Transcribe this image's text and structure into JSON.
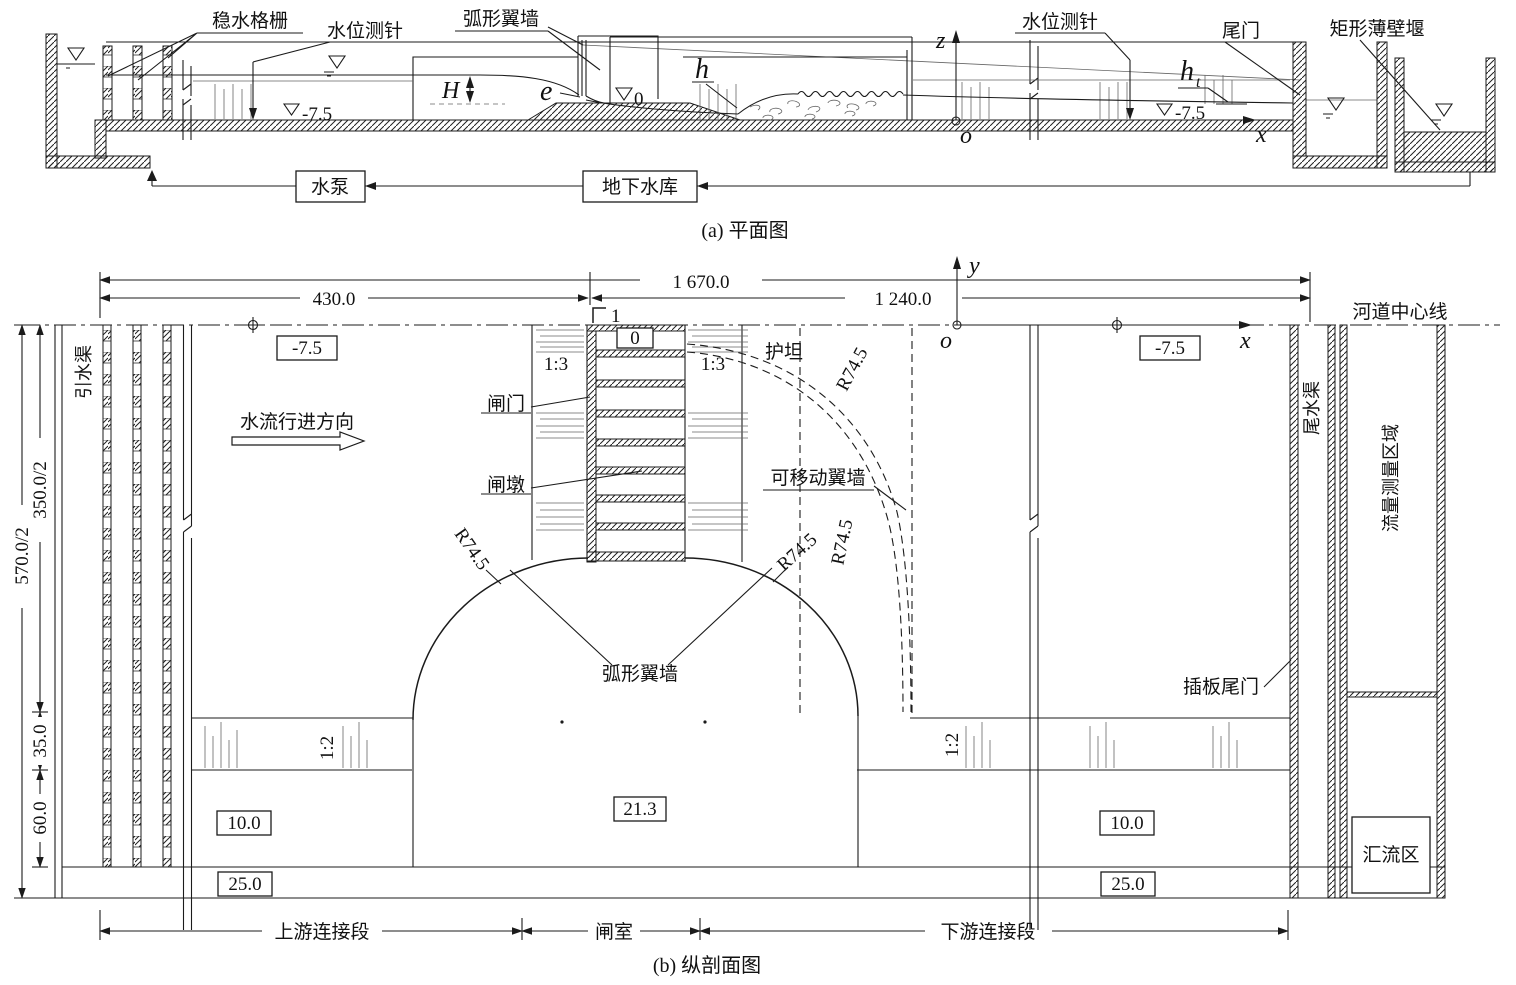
{
  "plan": {
    "caption": "(a) 平面图",
    "labels": {
      "grille": "稳水格栅",
      "gauge_left": "水位测针",
      "arc_wall": "弧形翼墙",
      "gauge_right": "水位测针",
      "tail_gate": "尾门",
      "weir": "矩形薄壁堰",
      "pump": "水泵",
      "reservoir": "地下水库"
    },
    "symbols": {
      "H": "H",
      "e": "e",
      "h": "h",
      "ht": "h",
      "ht_sub": "t",
      "z": "z",
      "o": "o",
      "x": "x",
      "zero": "0",
      "level_left": "-7.5",
      "level_right": "-7.5"
    }
  },
  "section": {
    "caption": "(b) 纵剖面图",
    "dims": {
      "total": "1 670.0",
      "left": "430.0",
      "right": "1 240.0",
      "half_total": "570.0/2",
      "half_main": "350.0/2",
      "berm": "35.0",
      "lower": "60.0"
    },
    "elevations": {
      "left": "-7.5",
      "right": "-7.5",
      "sill": "0",
      "basin": "21.3",
      "left10": "10.0",
      "right10": "10.0",
      "left25": "25.0",
      "right25": "25.0"
    },
    "slopes": {
      "s13l": "1:3",
      "s13r": "1:3",
      "s12l": "1:2",
      "s12r": "1:2"
    },
    "radii": {
      "r1": "R74.5",
      "r2": "R74.5",
      "r3": "R74.5",
      "r4": "R74.5"
    },
    "labels": {
      "centerline": "河道中心线",
      "diversion": "引水渠",
      "flow": "水流行进方向",
      "gate": "闸门",
      "pier": "闸墩",
      "apron": "护坦",
      "movable": "可移动翼墙",
      "arc_wall": "弧形翼墙",
      "plug_gate": "插板尾门",
      "tailrace": "尾水渠",
      "measure": "流量测量区域",
      "confluence": "汇流区",
      "seg_up": "上游连接段",
      "seg_gate": "闸室",
      "seg_down": "下游连接段",
      "section_no": "1"
    },
    "axes": {
      "x": "x",
      "y": "y",
      "o": "o"
    }
  }
}
